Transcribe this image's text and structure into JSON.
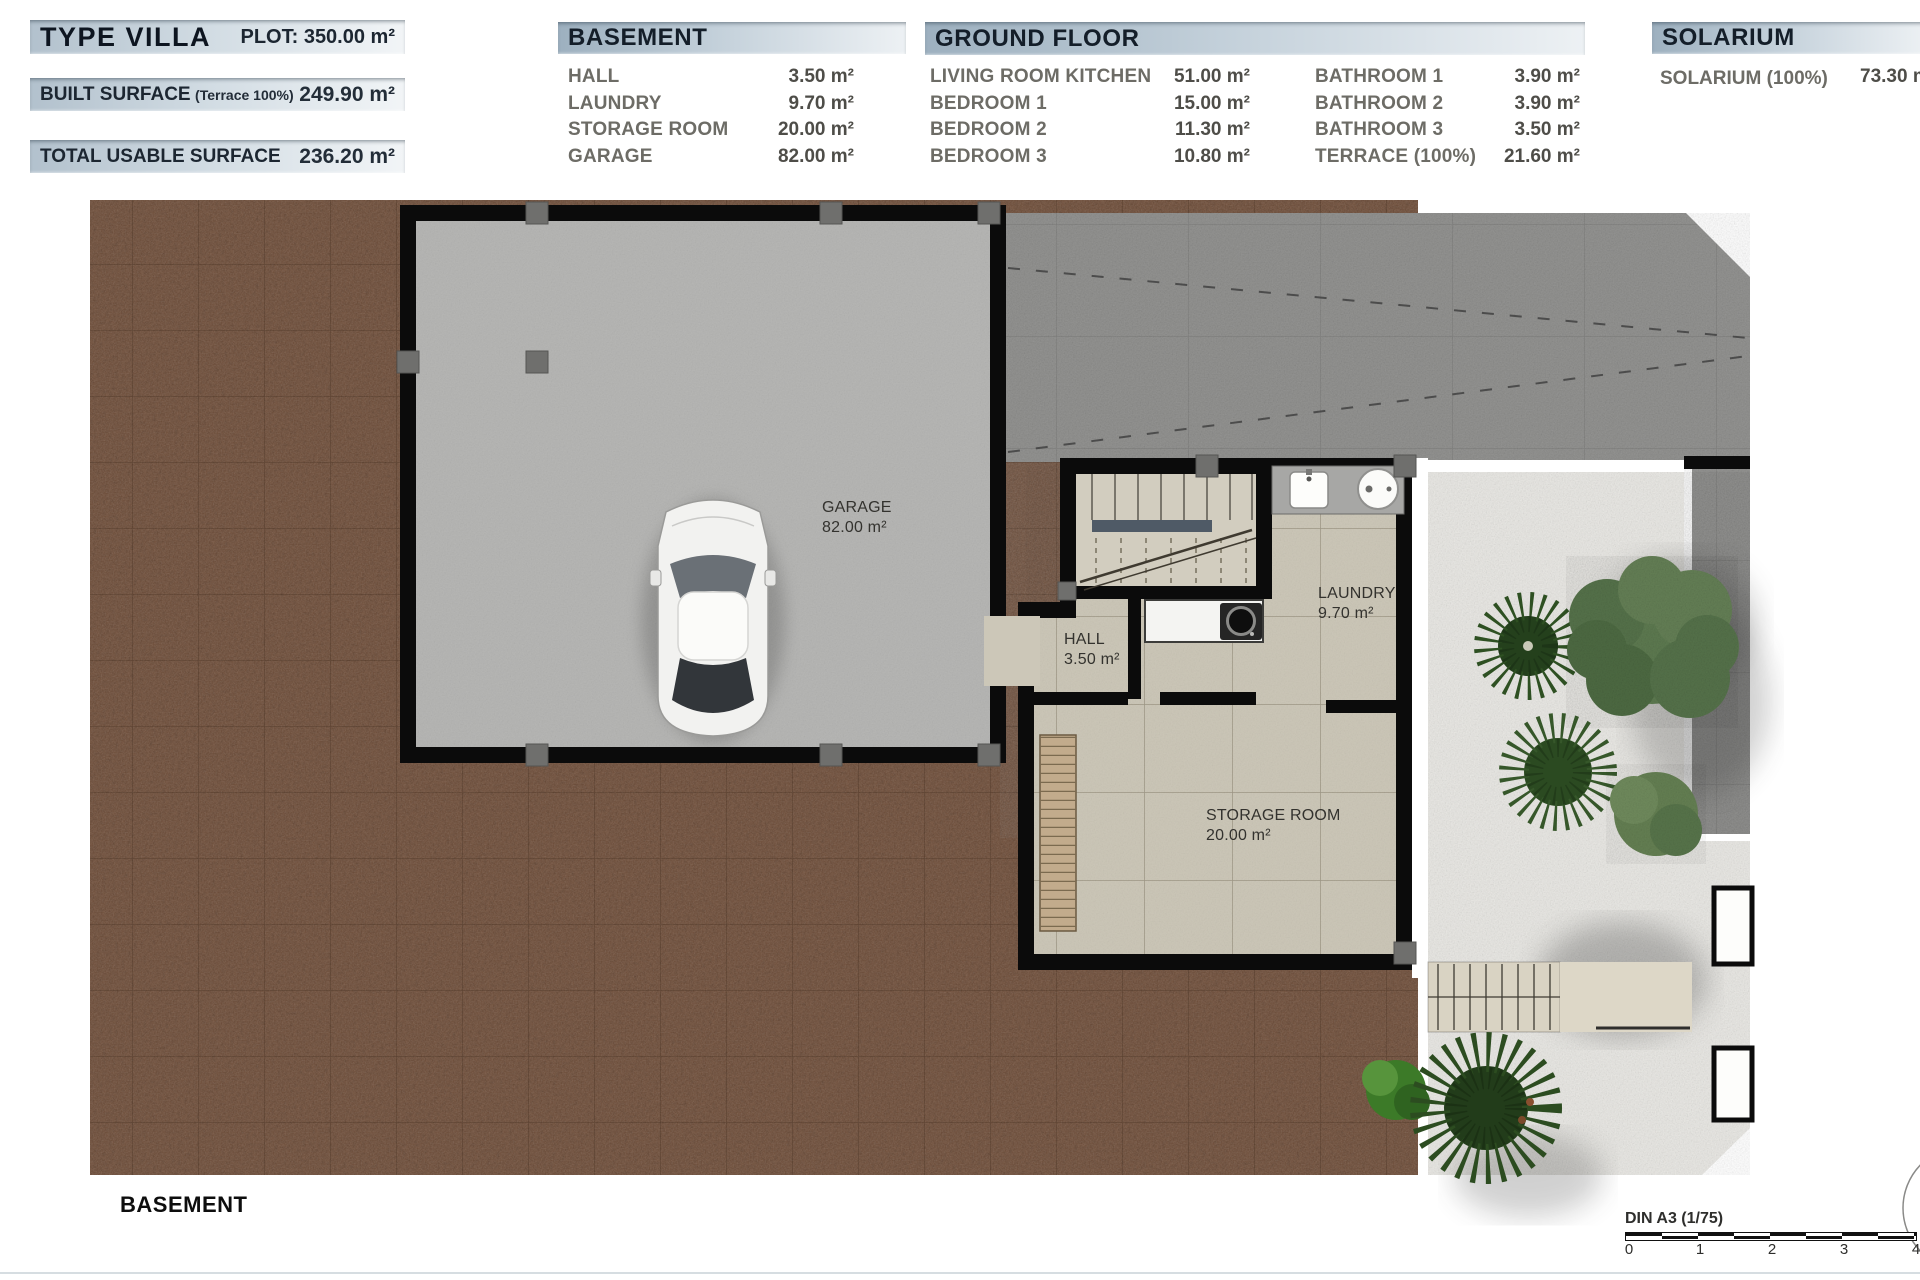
{
  "header": {
    "left": {
      "title": "TYPE VILLA",
      "plot": "PLOT: 350.00 m²",
      "built_label": "BUILT SURFACE",
      "built_sub": "(Terrace 100%)",
      "built_value": "249.90 m²",
      "usable_label": "TOTAL USABLE SURFACE",
      "usable_value": "236.20 m²"
    }
  },
  "tables": {
    "basement": {
      "title": "BASEMENT",
      "rows": [
        {
          "label": "HALL",
          "value": "3.50 m²"
        },
        {
          "label": "LAUNDRY",
          "value": "9.70 m²"
        },
        {
          "label": "STORAGE ROOM",
          "value": "20.00 m²"
        },
        {
          "label": "GARAGE",
          "value": "82.00 m²"
        }
      ]
    },
    "ground": {
      "title": "GROUND FLOOR",
      "col1": [
        {
          "label": "LIVING ROOM KITCHEN",
          "value": "51.00 m²"
        },
        {
          "label": "BEDROOM 1",
          "value": "15.00 m²"
        },
        {
          "label": "BEDROOM 2",
          "value": "11.30 m²"
        },
        {
          "label": "BEDROOM 3",
          "value": "10.80 m²"
        }
      ],
      "col2": [
        {
          "label": "BATHROOM 1",
          "value": "3.90 m²"
        },
        {
          "label": "BATHROOM 2",
          "value": "3.90 m²"
        },
        {
          "label": "BATHROOM 3",
          "value": "3.50 m²"
        },
        {
          "label": "TERRACE (100%)",
          "value": "21.60 m²"
        }
      ]
    },
    "solarium": {
      "title": "SOLARIUM",
      "row": {
        "label": "SOLARIUM (100%)",
        "value": "73.30 m²"
      }
    }
  },
  "plan": {
    "garage": {
      "name": "GARAGE",
      "area": "82.00 m²"
    },
    "hall": {
      "name": "HALL",
      "area": "3.50 m²"
    },
    "laundry": {
      "name": "LAUNDRY",
      "area": "9.70 m²"
    },
    "storage": {
      "name": "STORAGE ROOM",
      "area": "20.00 m²"
    }
  },
  "footer": {
    "floor": "BASEMENT",
    "scale": "DIN A3 (1/75)",
    "ticks": [
      "0",
      "1",
      "2",
      "3",
      "4"
    ]
  },
  "colors": {
    "header_bar_start": "#9db0bf",
    "header_bar_end": "#edf1f4",
    "header_text": "#141e29",
    "soil": "#6e4c37",
    "driveway": "#8d8d8b",
    "garage_floor": "#b4b4b2",
    "tile_floor": "#ccc7b8",
    "gravel": "#eae9e5",
    "wall": "#0b0b0b",
    "tree_green": "#4c6b3c"
  }
}
